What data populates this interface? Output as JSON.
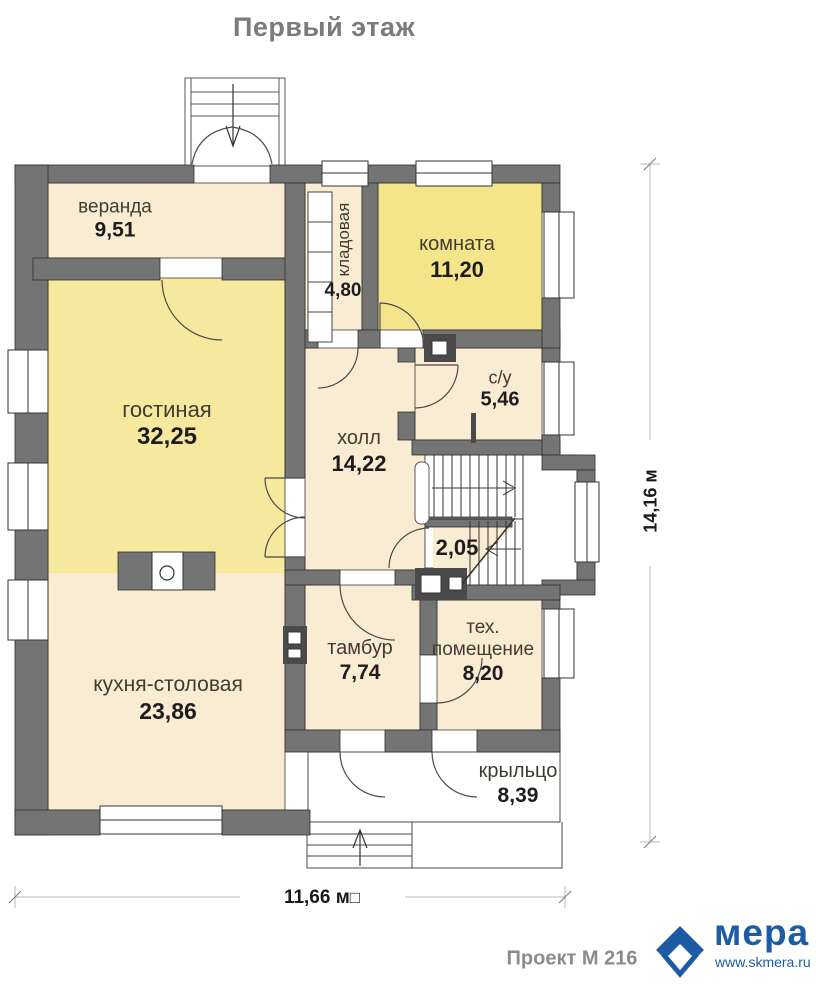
{
  "title": "Первый этаж",
  "rooms": {
    "veranda": {
      "name": "веранда",
      "area": "9,51"
    },
    "kladovaya": {
      "name": "кладовая",
      "area": "4,80"
    },
    "komnata": {
      "name": "комната",
      "area": "11,20"
    },
    "gostinaya": {
      "name": "гостиная",
      "area": "32,25"
    },
    "su": {
      "name": "с/у",
      "area": "5,46"
    },
    "holl": {
      "name": "холл",
      "area": "14,22"
    },
    "understairs": {
      "area": "2,05"
    },
    "tambur": {
      "name": "тамбур",
      "area": "7,74"
    },
    "tech": {
      "name": "тех. помещение",
      "area": "8,20"
    },
    "kitchen": {
      "name": "кухня-столовая",
      "area": "23,86"
    },
    "porch": {
      "name": "крыльцо",
      "area": "8,39"
    }
  },
  "dimensions": {
    "vertical": "14,16 м",
    "horizontal": "11,66 м",
    "missing_glyph": "□"
  },
  "footer": {
    "project": "Проект М 216",
    "brand": "мера",
    "website": "www.skmera.ru"
  },
  "colors": {
    "wall": "#747474",
    "room_cream": "#FAECD3",
    "room_yellow": "#F6E99D",
    "room_yellow_bright": "#F4E58A",
    "brand_blue": "#1D5BA5"
  }
}
